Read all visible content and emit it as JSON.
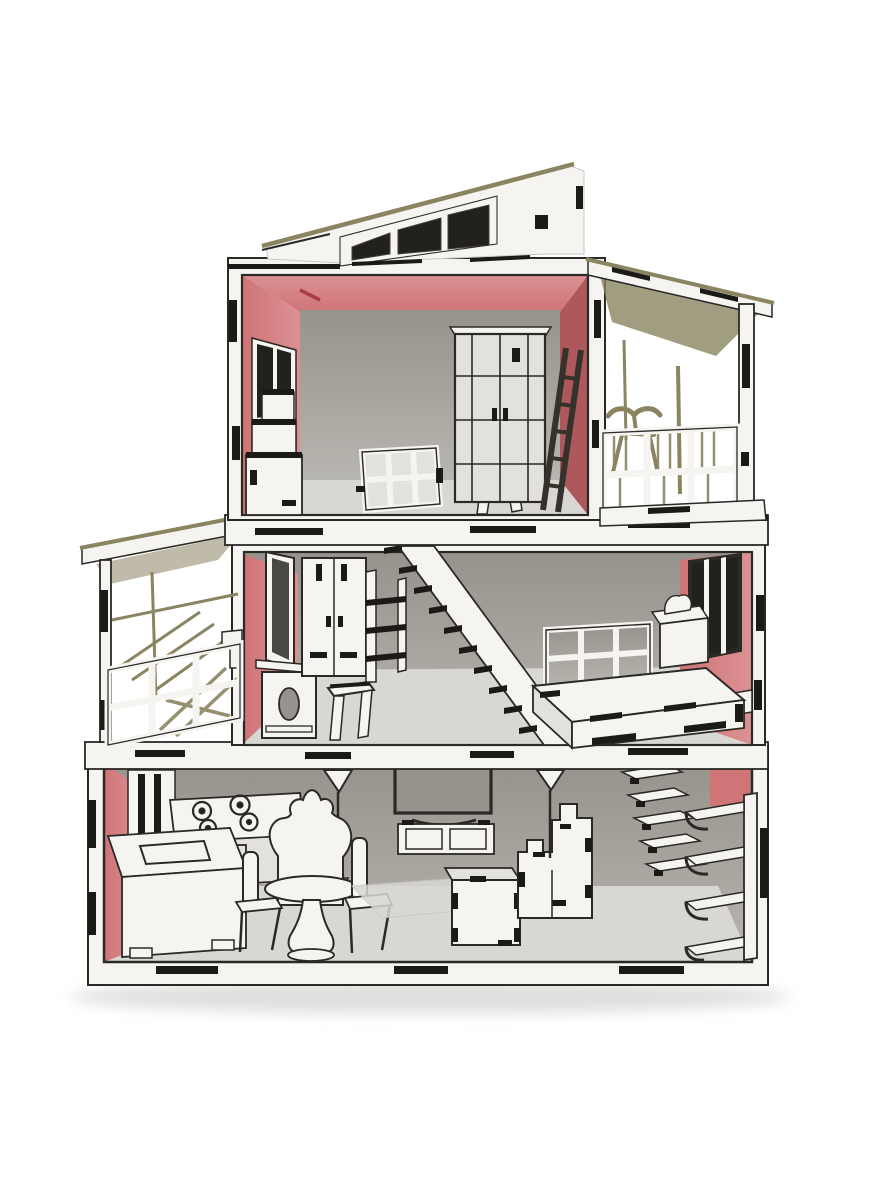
{
  "scene": {
    "type": "photograph",
    "description": "Three-story laser-cut plywood dollhouse with open front, pink accent walls, clerestory shed roof, side balcony and porch, furnished with miniature wooden furniture, photographed on a white background",
    "floors": [
      {
        "name": "top-floor",
        "items": [
          "shed roof with three clerestory windows",
          "pink ceiling and side walls",
          "dark side-wall window",
          "grid-front wardrobe",
          "leaning dark ladder",
          "white stool",
          "white window lattice leaning on wall",
          "staircase landing",
          "covered balcony with slatted railing and bench"
        ]
      },
      {
        "name": "middle-floor",
        "items": [
          "covered porch with railing and lounge furniture",
          "leaning mirror",
          "vanity table with oval cutout",
          "stool",
          "two-door wardrobe with open shelves",
          "straight staircase with dark treads",
          "platform bed",
          "grid headboard",
          "nightstand with lamp",
          "dark-framed window in pink wall"
        ]
      },
      {
        "name": "ground-floor",
        "items": [
          "pink kitchen wall",
          "tall cabinet",
          "four-burner stove",
          "sink counter",
          "floor lamp",
          "round pedestal dining table",
          "wing-back chair",
          "two dining chairs",
          "tv on media console",
          "rug",
          "cube coffee table",
          "tab-jointed sofa",
          "second floor lamp",
          "floating wall stairs",
          "corner shelf unit with four curved shelves"
        ]
      }
    ],
    "material_details": [
      "black laser-cut joint tabs along every edge",
      "olive plywood edge grain on roof lines"
    ]
  },
  "palette": {
    "background": "#ffffff",
    "wood-white": "#f5f4f1",
    "wood-shade": "#e3e1dc",
    "wood-edge-olive": "#8a8460",
    "outline-dark": "#2b2925",
    "tab-black": "#1c1a17",
    "wall-pink": "#cf7477",
    "wall-pink-light": "#db9193",
    "wall-pink-deep": "#ae585c",
    "interior-grey": "#96938c",
    "interior-grey-light": "#b8b6b0",
    "floor-grey": "#d9d7d3",
    "window-dark": "#23211c",
    "mirror-dark": "#4a4842",
    "panel-line": "#c9c7c1",
    "shadow": "#e0dfdd"
  }
}
